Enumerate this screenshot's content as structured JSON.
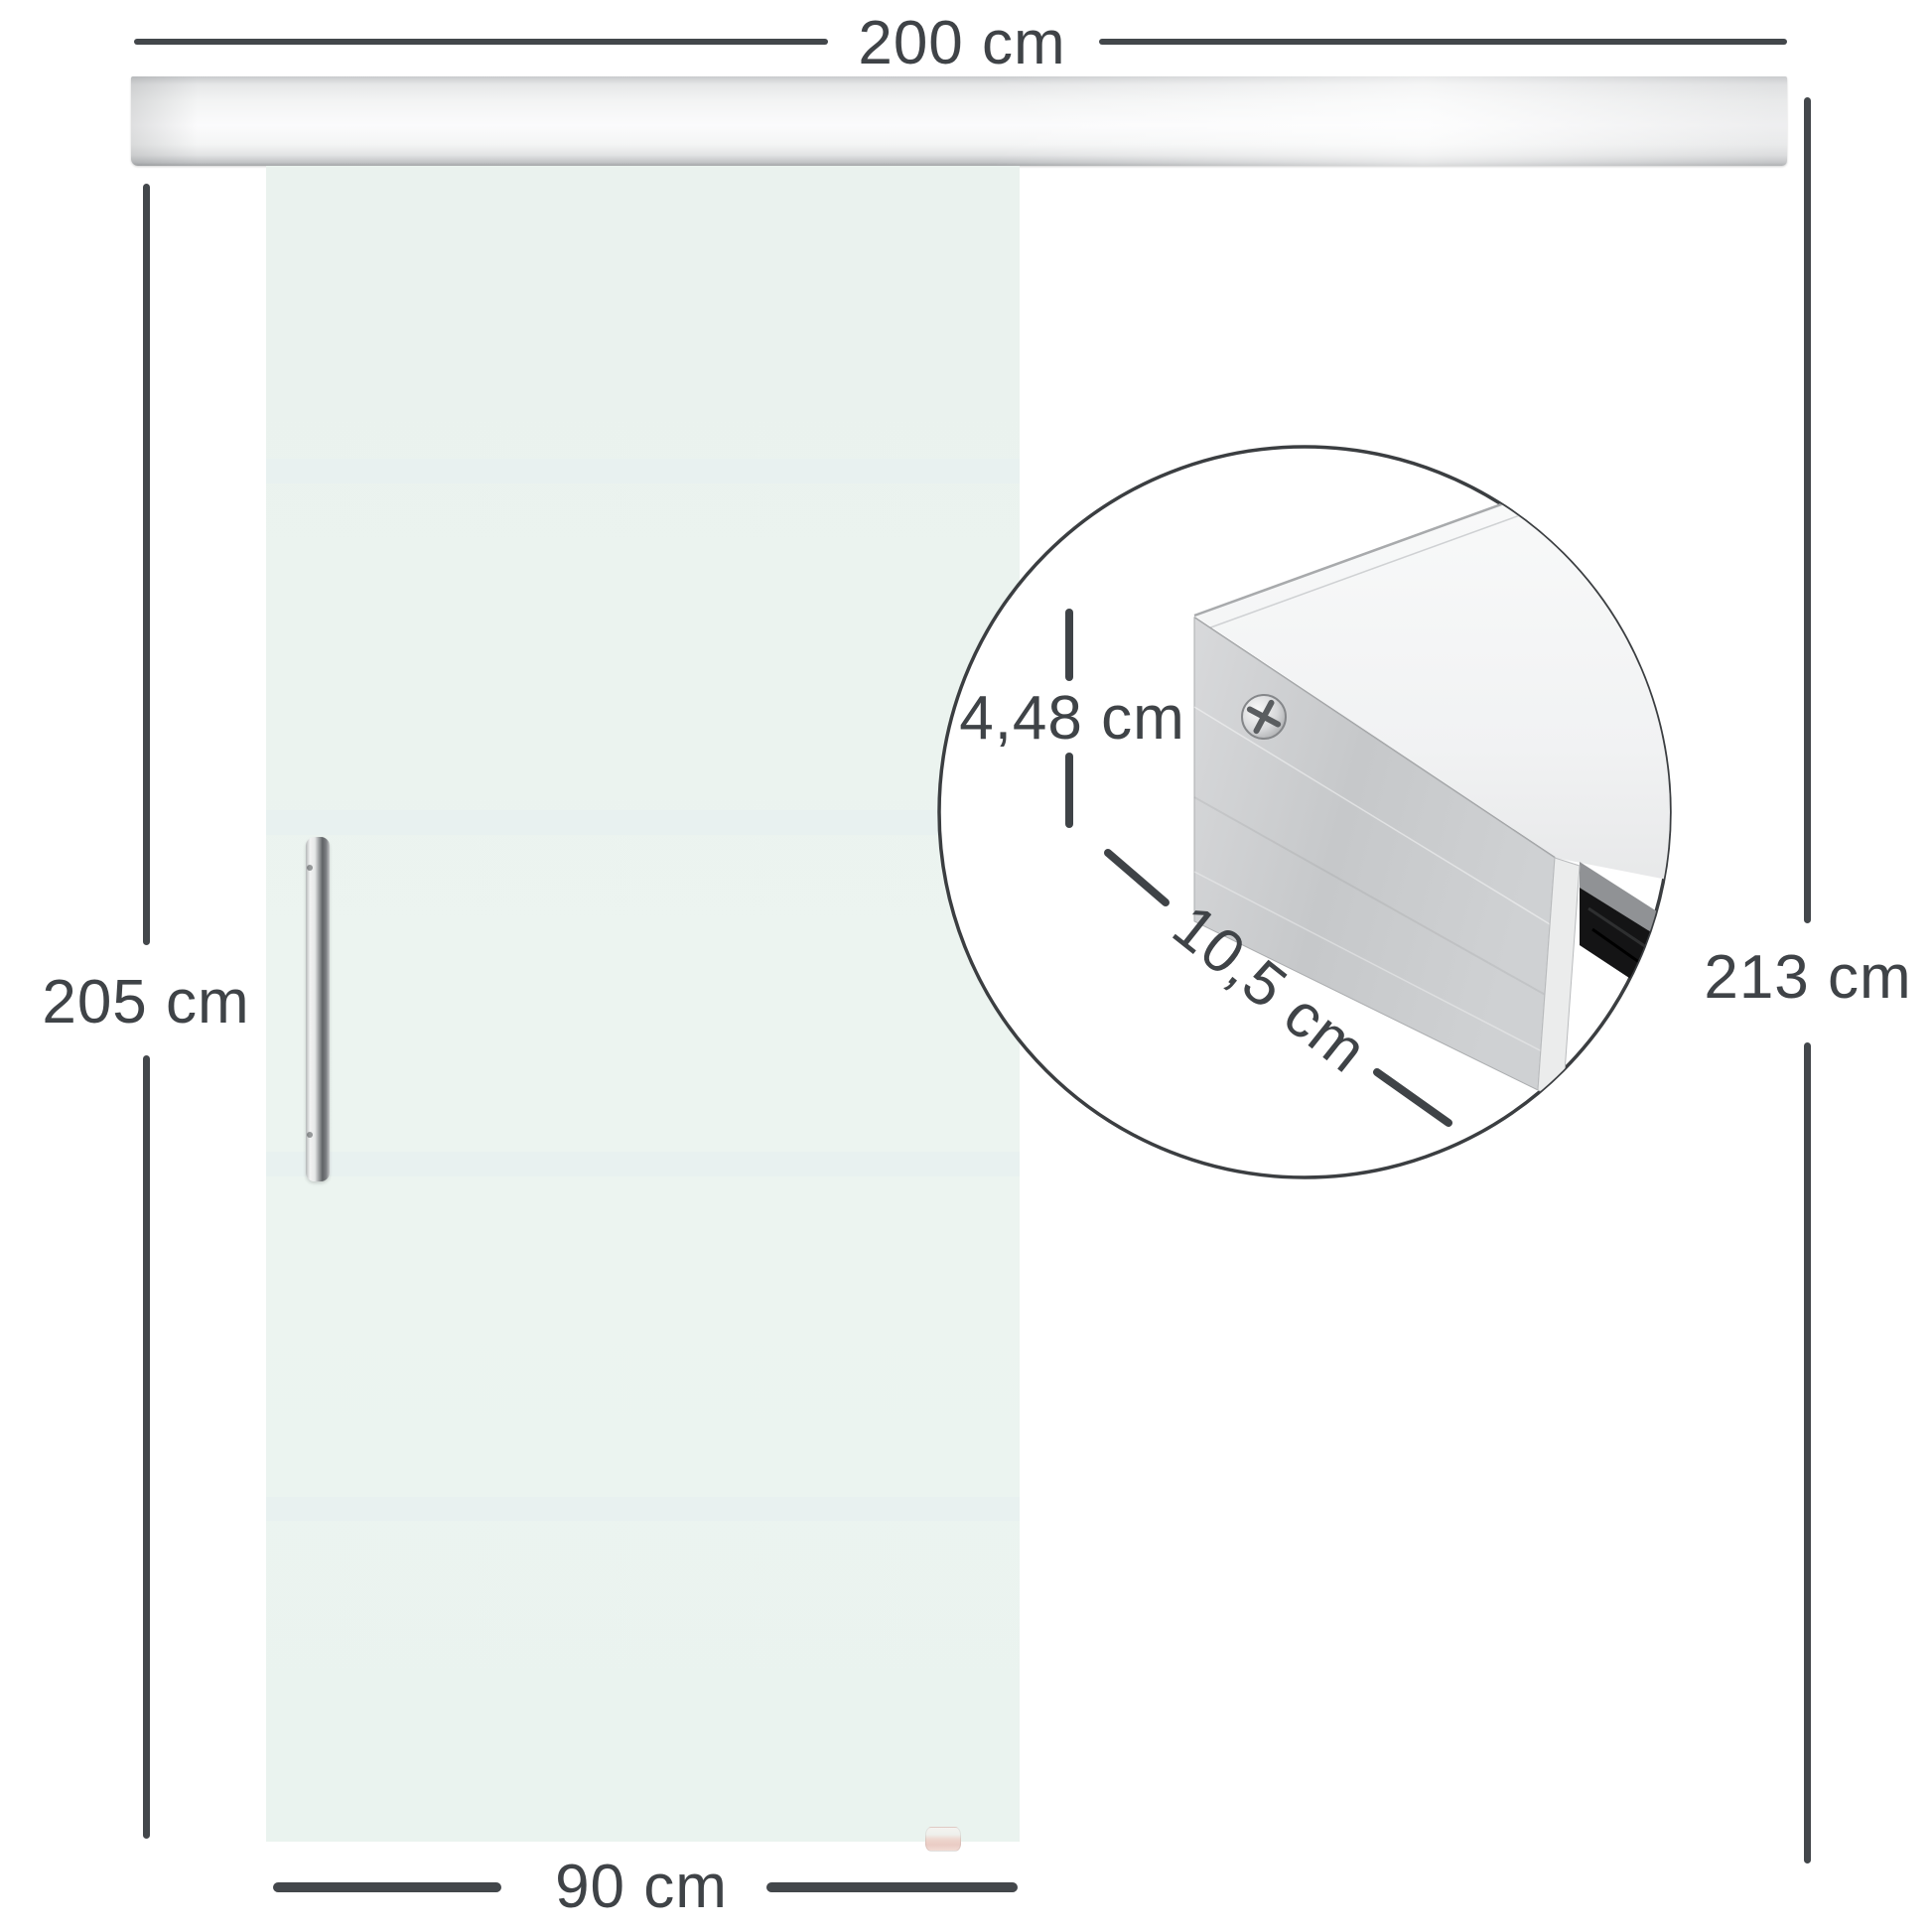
{
  "diagram": {
    "title": "sliding-glass-door-dimension-diagram",
    "top_width_label": "200 cm",
    "door_height_label": "205 cm",
    "total_height_label": "213 cm",
    "door_width_label": "90 cm",
    "inset": {
      "profile_height_label": "4,48 cm",
      "profile_depth_label": "10,5 cm"
    }
  },
  "colors": {
    "background": "#ffffff",
    "dimension_line": "#43474b",
    "dimension_text": "#3f4347",
    "glass": "#ebf3ef",
    "glass_stripe": "#e8f1f0",
    "rail_silver": "#e8e9ea",
    "handle_chrome": "#9da0a2",
    "inset_outline": "#3b3e41",
    "rail_plate": "#c9cbcd",
    "glass_slot_dark": "#141415",
    "floor_guide_pink": "#eaccc4"
  }
}
